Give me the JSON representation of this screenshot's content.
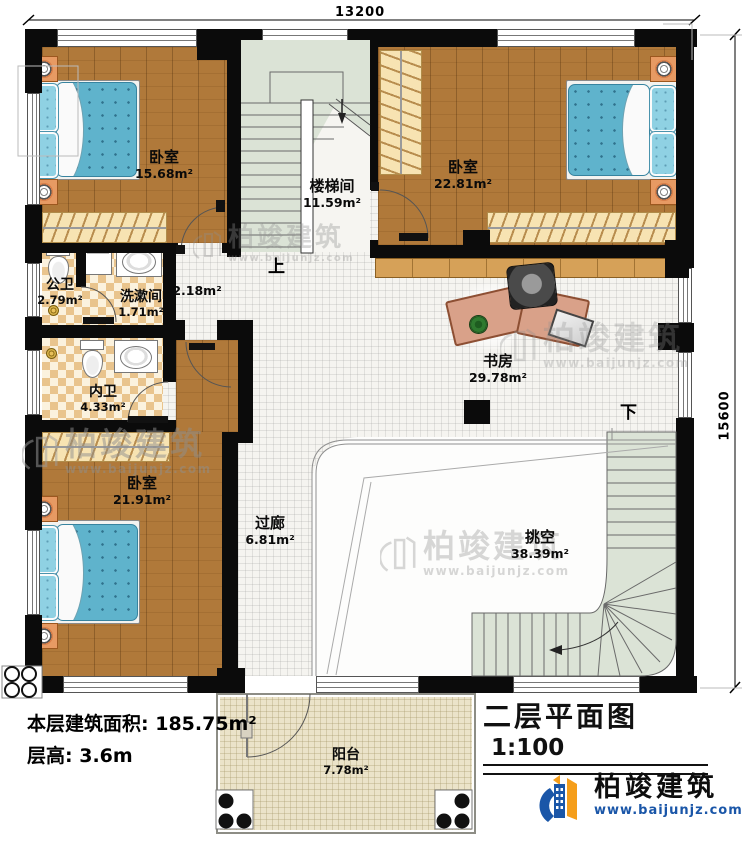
{
  "plan": {
    "dim_top": "13200",
    "dim_right": "15600",
    "rooms": {
      "bedroom_tl": {
        "name": "卧室",
        "area": "15.68m²"
      },
      "stairwell": {
        "name": "楼梯间",
        "area": "11.59m²"
      },
      "bedroom_tr": {
        "name": "卧室",
        "area": "22.81m²"
      },
      "public_bath": {
        "name": "公卫",
        "area": "2.79m²"
      },
      "washroom": {
        "name": "洗漱间",
        "area": "1.71m²"
      },
      "hall": {
        "area": "2.18m²"
      },
      "study": {
        "name": "书房",
        "area": "29.78m²"
      },
      "inner_bath": {
        "name": "内卫",
        "area": "4.33m²"
      },
      "bedroom_bl": {
        "name": "卧室",
        "area": "21.91m²"
      },
      "corridor": {
        "name": "过廊",
        "area": "6.81m²"
      },
      "void": {
        "name": "挑空",
        "area": "38.39m²"
      },
      "balcony": {
        "name": "阳台",
        "area": "7.78m²"
      }
    },
    "stairs": {
      "up": "上",
      "down": "下"
    }
  },
  "info": {
    "area_label": "本层建筑面积:",
    "area_value": "185.75m²",
    "height_label": "层高:",
    "height_value": "3.6m"
  },
  "title_block": {
    "title": "二层平面图",
    "scale": "1:100"
  },
  "brand": {
    "name": "柏竣建筑",
    "url": "www.baijunjz.com"
  },
  "watermark": {
    "text": "柏竣建筑",
    "url": "www.baijunjz.com"
  },
  "colors": {
    "brand_blue": "#1a56a8",
    "brand_orange": "#f59e1b",
    "wall": "#0b0b0b"
  }
}
